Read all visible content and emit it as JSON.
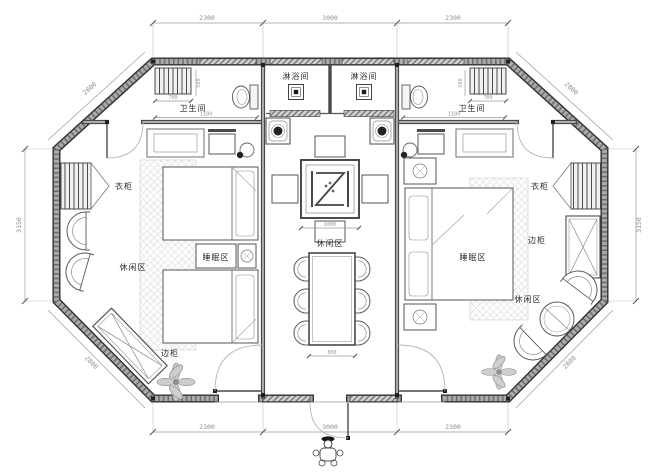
{
  "plan": {
    "labels": {
      "shower_left": "淋浴间",
      "shower_right": "淋浴间",
      "bath_left": "卫生间",
      "bath_right": "卫生间",
      "wardrobe_left": "衣柜",
      "wardrobe_right": "衣柜",
      "lounge_left": "休闲区",
      "lounge_center": "休闲区",
      "lounge_right": "休闲区",
      "sleep_left": "睡眠区",
      "sleep_right": "睡眠区",
      "sidecab_left": "边柜",
      "sidecab_right": "边柜"
    },
    "dims": {
      "top": [
        "2300",
        "3000",
        "2300"
      ],
      "bottom": [
        "2300",
        "3000",
        "2300"
      ],
      "side_left": "3150",
      "side_right": "3150",
      "diag": "2800",
      "radiator_w": "700",
      "radiator_h": "500",
      "bath_w": "1100",
      "table_w": "1000",
      "dining_w": "800"
    },
    "colors": {
      "wall_core": "#ababab",
      "wall_edge": "#2f2f2f",
      "interior_wall": "#4a4a4a",
      "dimension_text": "#8f8f8f",
      "label_text": "#2b2b2b",
      "hatch": "#c8c8c8",
      "background": "#ffffff"
    }
  }
}
